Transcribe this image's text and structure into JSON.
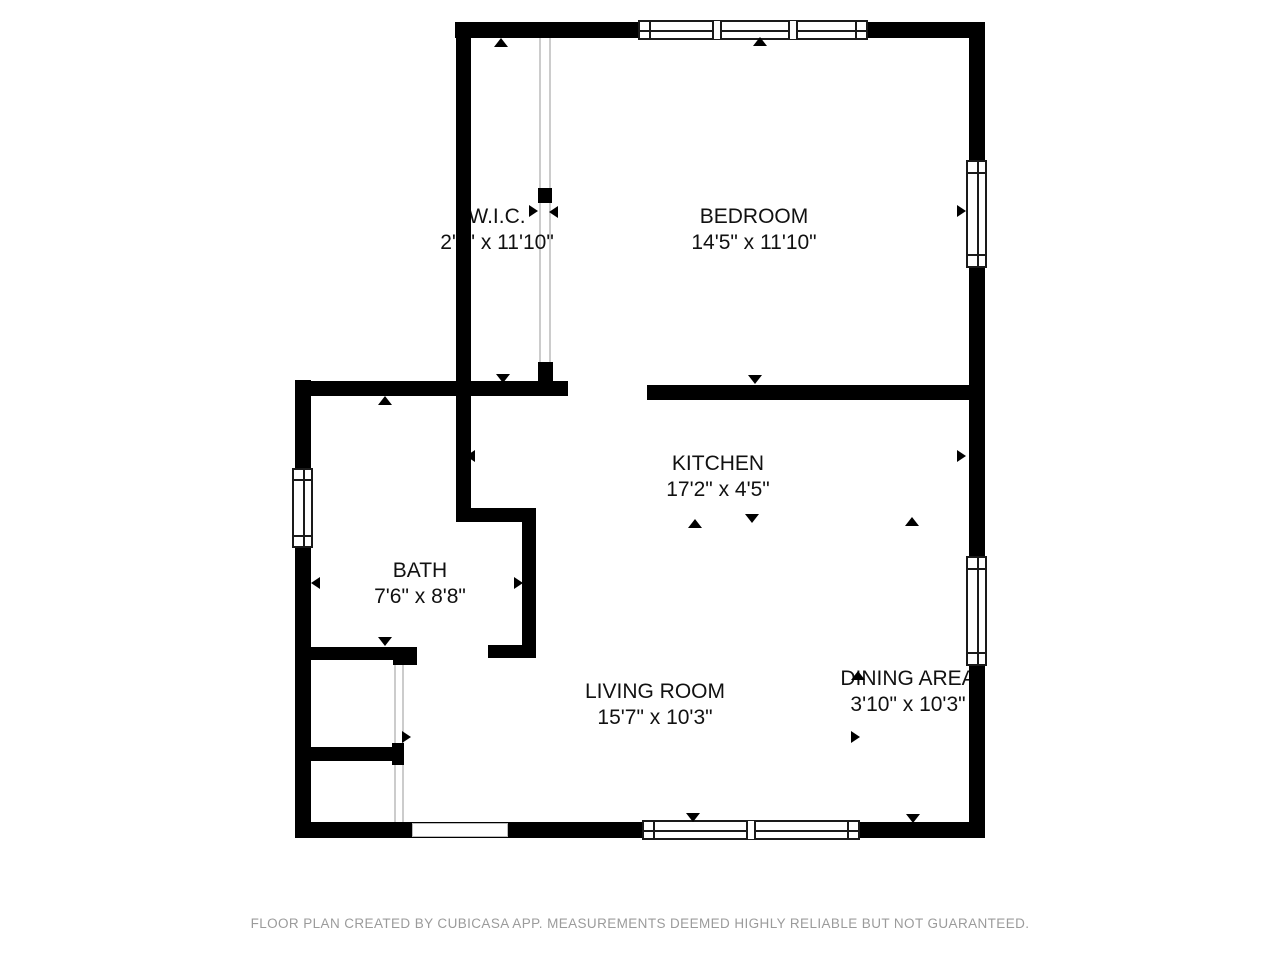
{
  "floor_plan": {
    "rooms": [
      {
        "name": "W.I.C.",
        "dimensions": "2'5\" x 11'10\""
      },
      {
        "name": "BEDROOM",
        "dimensions": "14'5\" x 11'10\""
      },
      {
        "name": "KITCHEN",
        "dimensions": "17'2\" x 4'5\""
      },
      {
        "name": "BATH",
        "dimensions": "7'6\" x 8'8\""
      },
      {
        "name": "LIVING ROOM",
        "dimensions": "15'7\" x 10'3\""
      },
      {
        "name": "DINING AREA",
        "dimensions": "3'10\" x 10'3\""
      }
    ],
    "footer_text": "FLOOR PLAN CREATED BY CUBICASA APP. MEASUREMENTS DEEMED HIGHLY RELIABLE BUT NOT GUARANTEED.",
    "colors": {
      "wall": "#000000",
      "background": "#ffffff",
      "footer": "#9b9b9b",
      "thin_partition": "#cccccc"
    }
  }
}
